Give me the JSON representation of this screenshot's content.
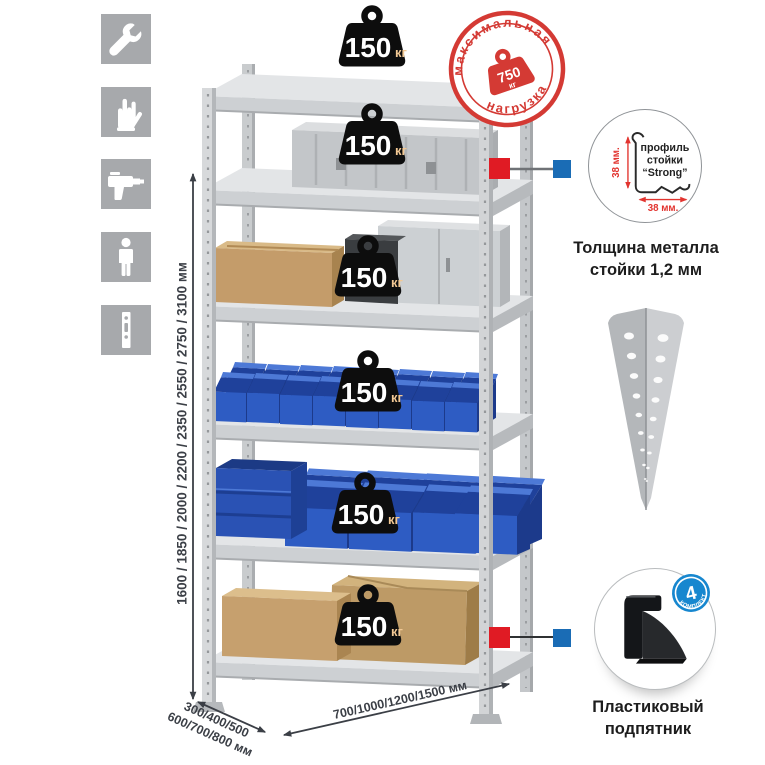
{
  "canvas": {
    "width": 765,
    "height": 765,
    "background": "#ffffff"
  },
  "sidebar": {
    "tile_color": "#a7a9ac",
    "items": [
      {
        "icon": "wrench-icon"
      },
      {
        "icon": "gloves-icon"
      },
      {
        "icon": "drill-icon"
      },
      {
        "icon": "person-icon"
      },
      {
        "icon": "perforated-post-icon"
      }
    ]
  },
  "dimensions": {
    "height": "1600 / 1850 / 2000 / 2200 / 2350 / 2550 / 2750 / 3100 мм",
    "depth_line1": "300/400/500",
    "depth_line2": "600/700/800 мм",
    "width": "700/1000/1200/1500 мм",
    "line_color": "#3b3f46"
  },
  "shelf_load": {
    "value": "150",
    "unit": "кг",
    "shelves_count": 6
  },
  "max_load_stamp": {
    "top_text": "максимальная",
    "bottom_text": "нагрузка",
    "value": "750",
    "unit": "кг",
    "color": "#d43a34"
  },
  "profile_detail": {
    "label_line1": "профиль",
    "label_line2": "стойки",
    "label_line3": "“Strong”",
    "dim_vertical": "38 мм.",
    "dim_horizontal": "38 мм.",
    "caption_line1": "Толщина металла",
    "caption_line2": "стойки 1,2 мм",
    "dim_color": "#e2342f"
  },
  "foot_detail": {
    "badge_value": "4",
    "badge_text": "в комплекте",
    "badge_color": "#1787cf",
    "caption_line1": "Пластиковый",
    "caption_line2": "подпятник"
  },
  "connectors": {
    "red": "#e01b24",
    "blue": "#1a6cb5"
  },
  "palette": {
    "metal_light": "#d7d9db",
    "bin_blue": "#2e5cc3",
    "cardboard": "#c49c6a"
  }
}
